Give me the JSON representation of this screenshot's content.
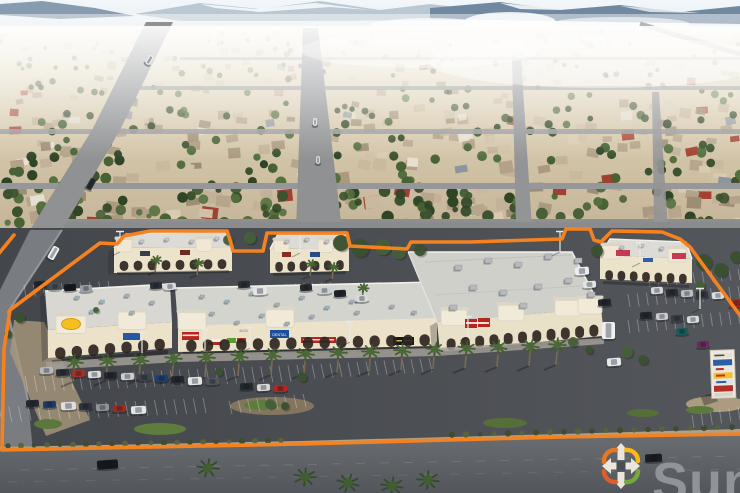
{
  "branding": {
    "logo_text": "Sun",
    "logo_text_color": "#8f9499",
    "logo_colors": {
      "arms": "#eae6db",
      "center": "#4a4e52",
      "swoosh_orange": "#e87722",
      "swoosh_yellow": "#fdb913",
      "swoosh_green": "#76a73c",
      "swoosh_red_orange": "#e05c2a"
    }
  },
  "property": {
    "outline_color": "#f5821f",
    "rooftop_address_marking": "4620"
  },
  "signs": {
    "dental": "DENTAL"
  }
}
